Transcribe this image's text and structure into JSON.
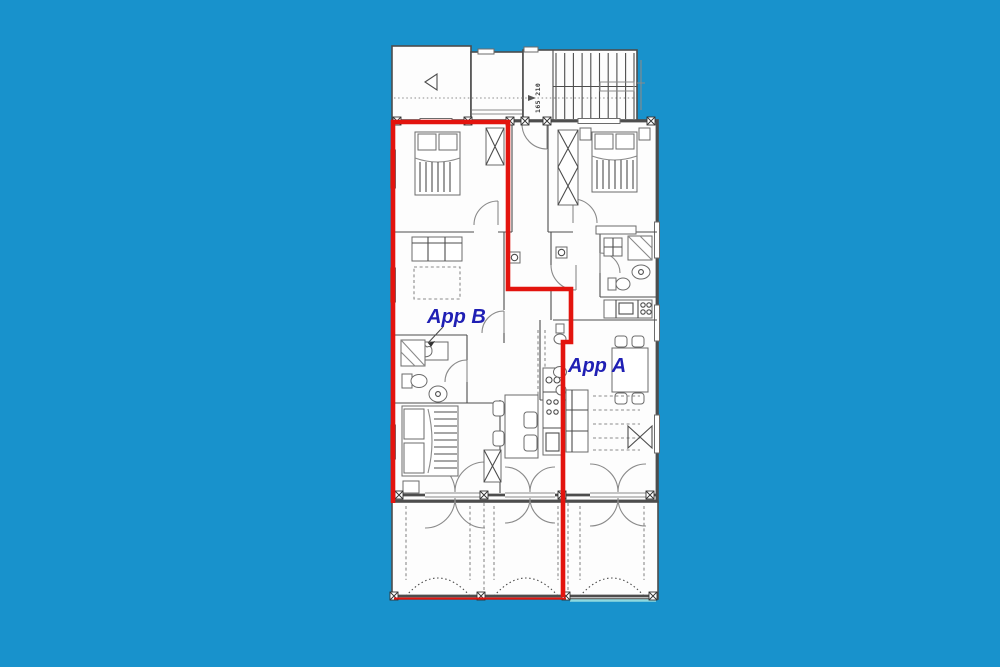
{
  "floor_plan": {
    "labels": {
      "apartment_a": "App A",
      "apartment_b": "App B",
      "stair_dimension": "165 210"
    },
    "colors": {
      "background": "#1892cc",
      "paper": "#fdfdfd",
      "line": "#4d4d4d",
      "line_light": "#8a8a8a",
      "boundary_red": "#e3140e",
      "label_blue": "#1f1fb4"
    }
  }
}
